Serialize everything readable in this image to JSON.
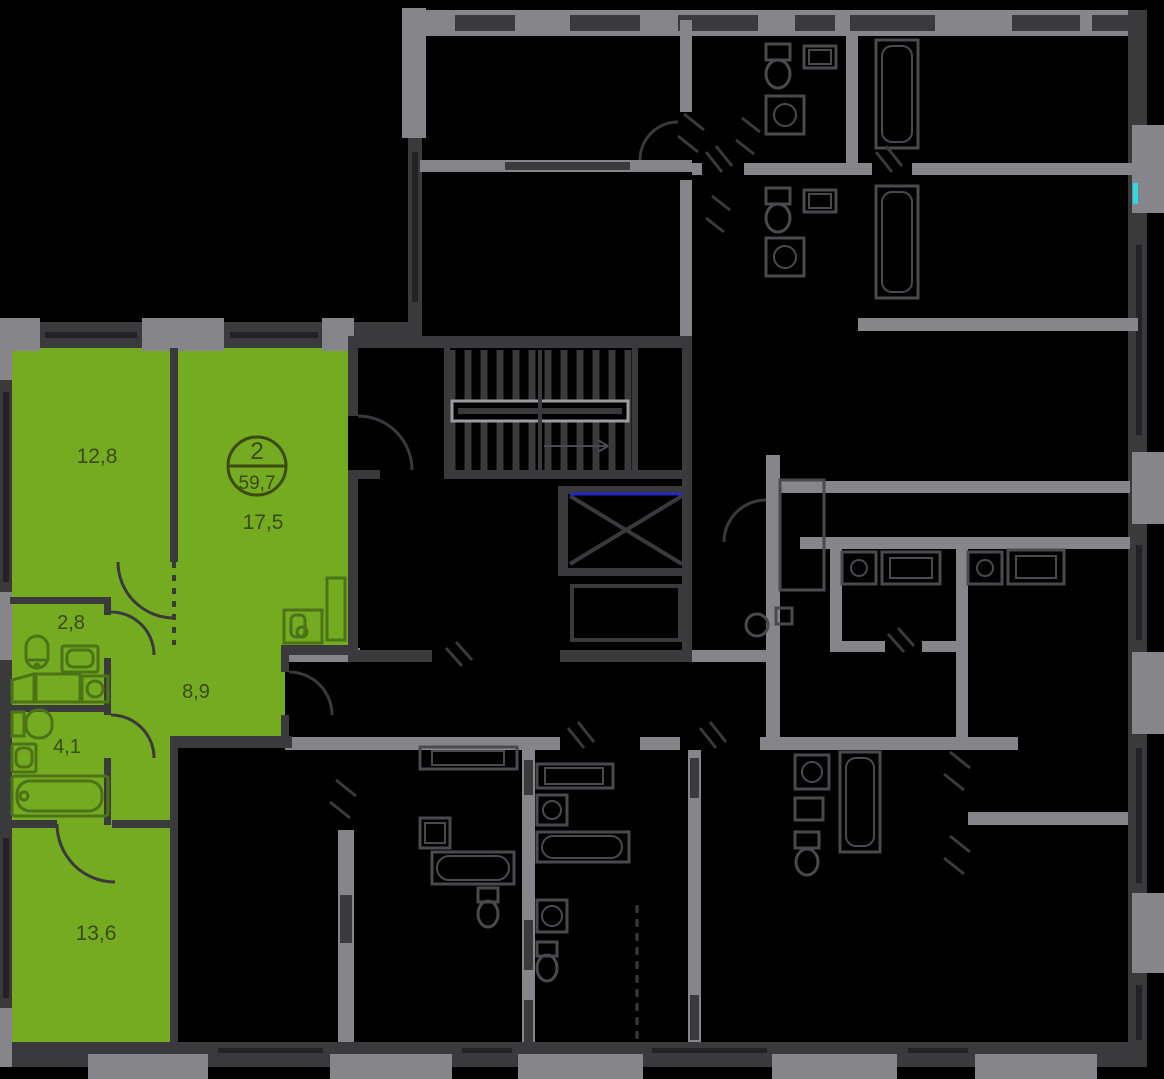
{
  "plan": {
    "kind": "residential-floor-plan",
    "highlighted_apartment": {
      "badge": {
        "rooms": "2",
        "total_area": "59,7"
      },
      "rooms": [
        {
          "name": "bedroom-1",
          "area": "12,8"
        },
        {
          "name": "living-room",
          "area": "17,5"
        },
        {
          "name": "water-closet",
          "area": "2,8"
        },
        {
          "name": "hallway",
          "area": "8,9"
        },
        {
          "name": "bathroom",
          "area": "4,1"
        },
        {
          "name": "bedroom-2",
          "area": "13,6"
        }
      ]
    },
    "colors": {
      "highlight_green": "#74ab20",
      "wall_dark": "#3a3a3c",
      "wall_gray": "#85858a",
      "label_text": "#3c4a12",
      "elevator_accent_blue": "#2626c9",
      "entrance_accent_cyan": "#2bd8e6",
      "background": "#000000"
    }
  }
}
